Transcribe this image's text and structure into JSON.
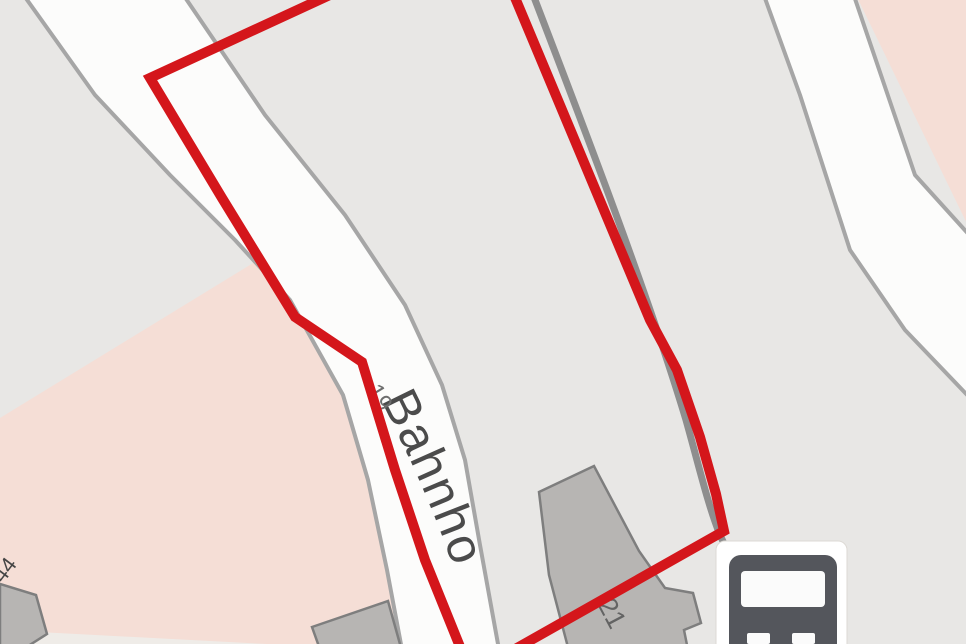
{
  "map": {
    "background_color": "#e8e7e5",
    "areas": {
      "residential_left": {
        "points": "0,418 258,260 305,312 345,398 370,485 388,568 403,655 0,655",
        "fill": "#f5ded6"
      },
      "residential_top_right": {
        "points": "856,-5 972,-5 972,234",
        "fill": "#f5ded6"
      },
      "light_strip_bottom_left": {
        "points": "0,630 305,646 305,655 0,655",
        "fill": "#efece8"
      }
    },
    "roads": {
      "main_road": {
        "points": "20,-10 95,95 170,175 235,240 290,300 343,395 368,480 387,570 403,655 500,655 480,545 465,460 442,385 405,305 345,215 265,115 180,-10",
        "fill": "#fcfcfb",
        "casing_color": "#a6a6a6",
        "casing_width": 4
      },
      "right_road": {
        "points": "762,-10 800,95 850,250 905,330 972,400 972,238 915,175 852,-10",
        "fill": "#fcfcfb",
        "casing_color": "#a6a6a6",
        "casing_width": 4
      }
    },
    "footpath": {
      "d": "M 532,-8 C 585,130 650,300 686,420 C 700,470 708,505 720,535 C 730,558 740,566 752,573",
      "color": "#8e8e8e",
      "width": 7
    },
    "buildings": {
      "fill": "#b7b5b3",
      "stroke": "#7e7e7e",
      "stroke_width": 2.5,
      "items": [
        {
          "name": "building-21",
          "points": "539,492 594,466 639,551 665,588 693,593 701,623 684,630 689,655 570,655 549,575"
        },
        {
          "name": "building-bottom-left",
          "points": "312,627 388,601 403,655 322,655"
        },
        {
          "name": "building-44",
          "points": "0,584 36,595 47,634 14,655 0,655"
        }
      ]
    },
    "labels": {
      "street_name": {
        "text": "Bahnho",
        "path_d": "M 380,398 C 420,478 452,548 484,668",
        "font_size": 50,
        "letter_spacing": 2,
        "color": "#4b4b4b"
      },
      "house_numbers": [
        {
          "text": "19",
          "transform": "translate(366,390) rotate(59)",
          "font_size": 24,
          "color": "#6d6d6d"
        },
        {
          "text": "21",
          "transform": "translate(597,604) rotate(62)",
          "font_size": 27,
          "color": "#636363"
        },
        {
          "text": "44",
          "transform": "translate(3,584) rotate(-53)",
          "font_size": 22,
          "color": "#454545"
        }
      ]
    },
    "bus_stop": {
      "icon": "bus-front-icon",
      "card_fill": "#ffffff",
      "card_stroke": "#dddad5",
      "body_color": "#54565c",
      "glass_color": "#fbfbfb"
    },
    "selection_outline": {
      "points": "345,-12 150,78 222,198 295,317 362,362 395,470 425,560 471,674 724,531 716,494 700,437 677,370 650,320 583,160 516,0 510,-14",
      "color": "#d4161b",
      "width": 10
    }
  }
}
